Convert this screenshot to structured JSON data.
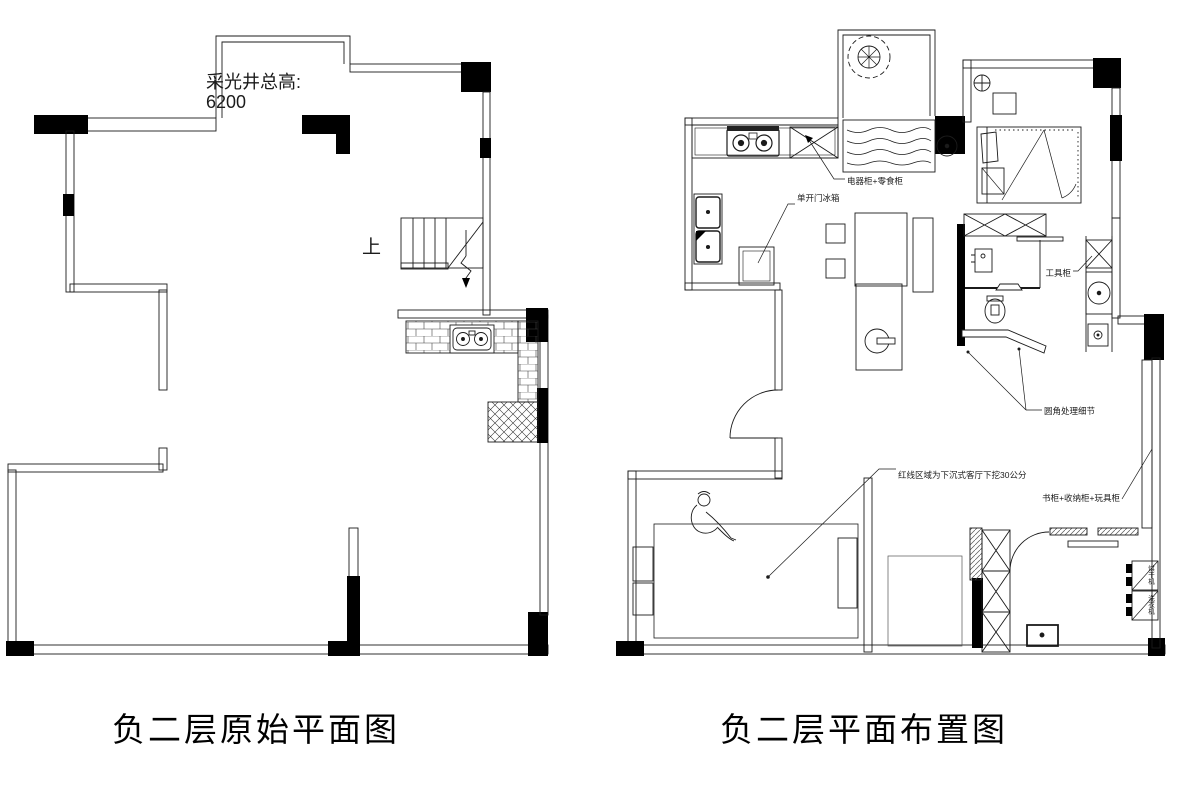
{
  "left_plan": {
    "title": "负二层原始平面图",
    "skylight_note": {
      "line1": "采光井总高:",
      "line2": "6200"
    },
    "stairs_up_label": "上"
  },
  "right_plan": {
    "title": "负二层平面布置图",
    "annotations": {
      "appliance_cabinet": "电器柜+零食柜",
      "fridge": "单开门冰箱",
      "tool_cabinet": "工具柜",
      "rounded_corner": "圆角处理细节",
      "sunken_area": "红线区域为下沉式客厅下挖30公分",
      "storage_wall": "书柜+收纳柜+玩具柜",
      "dryer": "烘干机",
      "washer": "洗衣机"
    }
  },
  "colors": {
    "line": "#1b1b1b",
    "background": "#ffffff"
  }
}
